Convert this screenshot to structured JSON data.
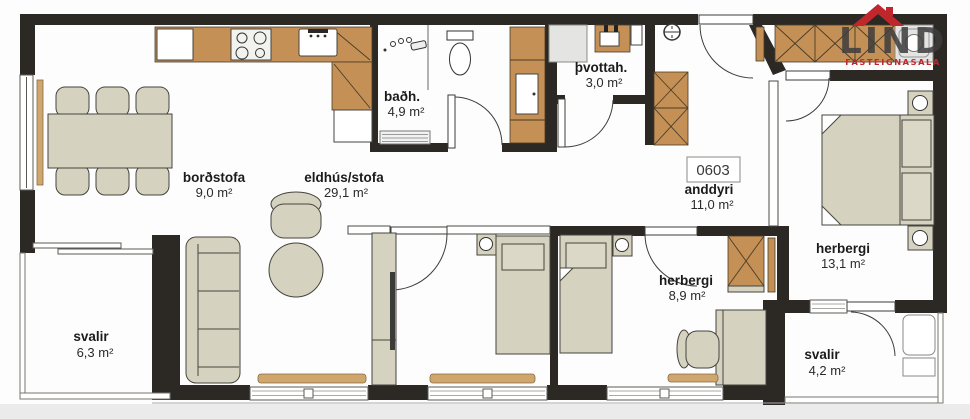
{
  "plan": {
    "apartment_number": "0603",
    "rooms": [
      {
        "label": "borðstofa",
        "area": "9,0 m²"
      },
      {
        "label": "eldhús/stofa",
        "area": "29,1 m²"
      },
      {
        "label": "baðh.",
        "area": "4,9 m²"
      },
      {
        "label": "þvottah.",
        "area": "3,0 m²"
      },
      {
        "label": "anddyri",
        "area": "11,0 m²"
      },
      {
        "label": "herbergi",
        "area": "13,1 m²"
      },
      {
        "label": "herbergi",
        "area": "8,9 m²"
      },
      {
        "label": "svalir",
        "area": "6,3 m²"
      },
      {
        "label": "svalir",
        "area": "4,2 m²"
      }
    ],
    "logo": {
      "name": "LIND",
      "tagline": "FASTEIGNASALA"
    },
    "colors": {
      "wall": "#2c2925",
      "wood": "#c49055",
      "wood_light": "#cfa66e",
      "furniture": "#d6d2c0",
      "accent_red": "#c0272d"
    }
  }
}
